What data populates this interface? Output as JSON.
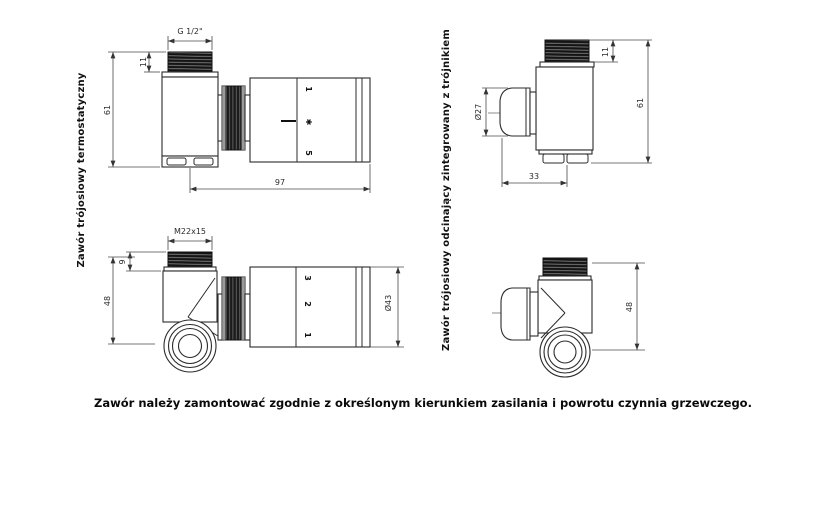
{
  "drawing": {
    "caption": "Zawór należy zamontować zgodnie z określonym kierunkiem zasilania i powrotu czynnia grzewczego."
  },
  "views": {
    "thermostatic": {
      "title": "Zawór trójosiowy termostatyczny",
      "straight": {
        "dim_thread": "G 1/2\"",
        "dim_thread_len": "11",
        "dim_height": "61",
        "dim_length": "97",
        "head_marks": [
          "1",
          "✱",
          "5"
        ]
      },
      "angled": {
        "dim_thread": "M22x15",
        "dim_thread_len": "9",
        "dim_height": "48",
        "dim_head_dia": "Ø43",
        "head_marks": [
          "3",
          "2",
          "1"
        ]
      }
    },
    "shutoff": {
      "title": "Zawór trójosiowy odcinający zintegrowany z trójnikiem",
      "straight": {
        "dim_thread_len": "11",
        "dim_height": "61",
        "dim_knob_dia": "Ø27",
        "dim_offset": "33"
      },
      "angled": {
        "dim_height": "48"
      }
    }
  }
}
